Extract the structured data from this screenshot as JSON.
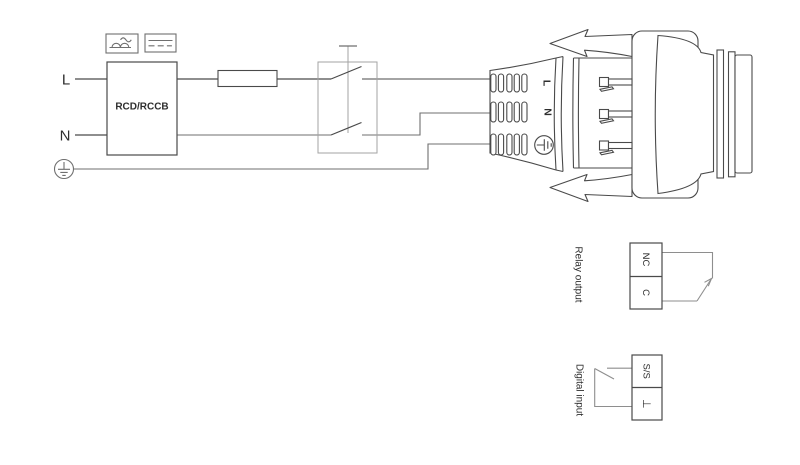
{
  "supply": {
    "line_label": "L",
    "neutral_label": "N",
    "rcd_label": "RCD/RCCB"
  },
  "plug": {
    "line_label": "L",
    "neutral_label": "N"
  },
  "relay_output": {
    "label": "Relay output",
    "terminal_top": "NC",
    "terminal_bottom": "C"
  },
  "digital_input": {
    "label": "Digital input",
    "terminal_top": "S/S",
    "terminal_bottom": "⊥"
  },
  "icons": {
    "rcd_pulsating_dc_icon": "half-wave humps with sine tilde",
    "rcd_smooth_dc_icon": "solid line over dashed line",
    "earth_icon": "protective earth in circle",
    "plug_earth_icon": "protective earth in circle, rotated 90",
    "fuse_icon": "empty rectangle fuse",
    "switch_icon": "double-pole switch with actuator bar",
    "clip_arrow_icon": "left-pointing release-clip arrow"
  },
  "colors": {
    "background": "#ffffff",
    "stroke_dark": "#4a4a4a",
    "stroke_medium": "#6f6f6f",
    "stroke_light": "#a3a3a3",
    "wire_gray": "#8e8e8e",
    "text": "#2e2e2e"
  }
}
